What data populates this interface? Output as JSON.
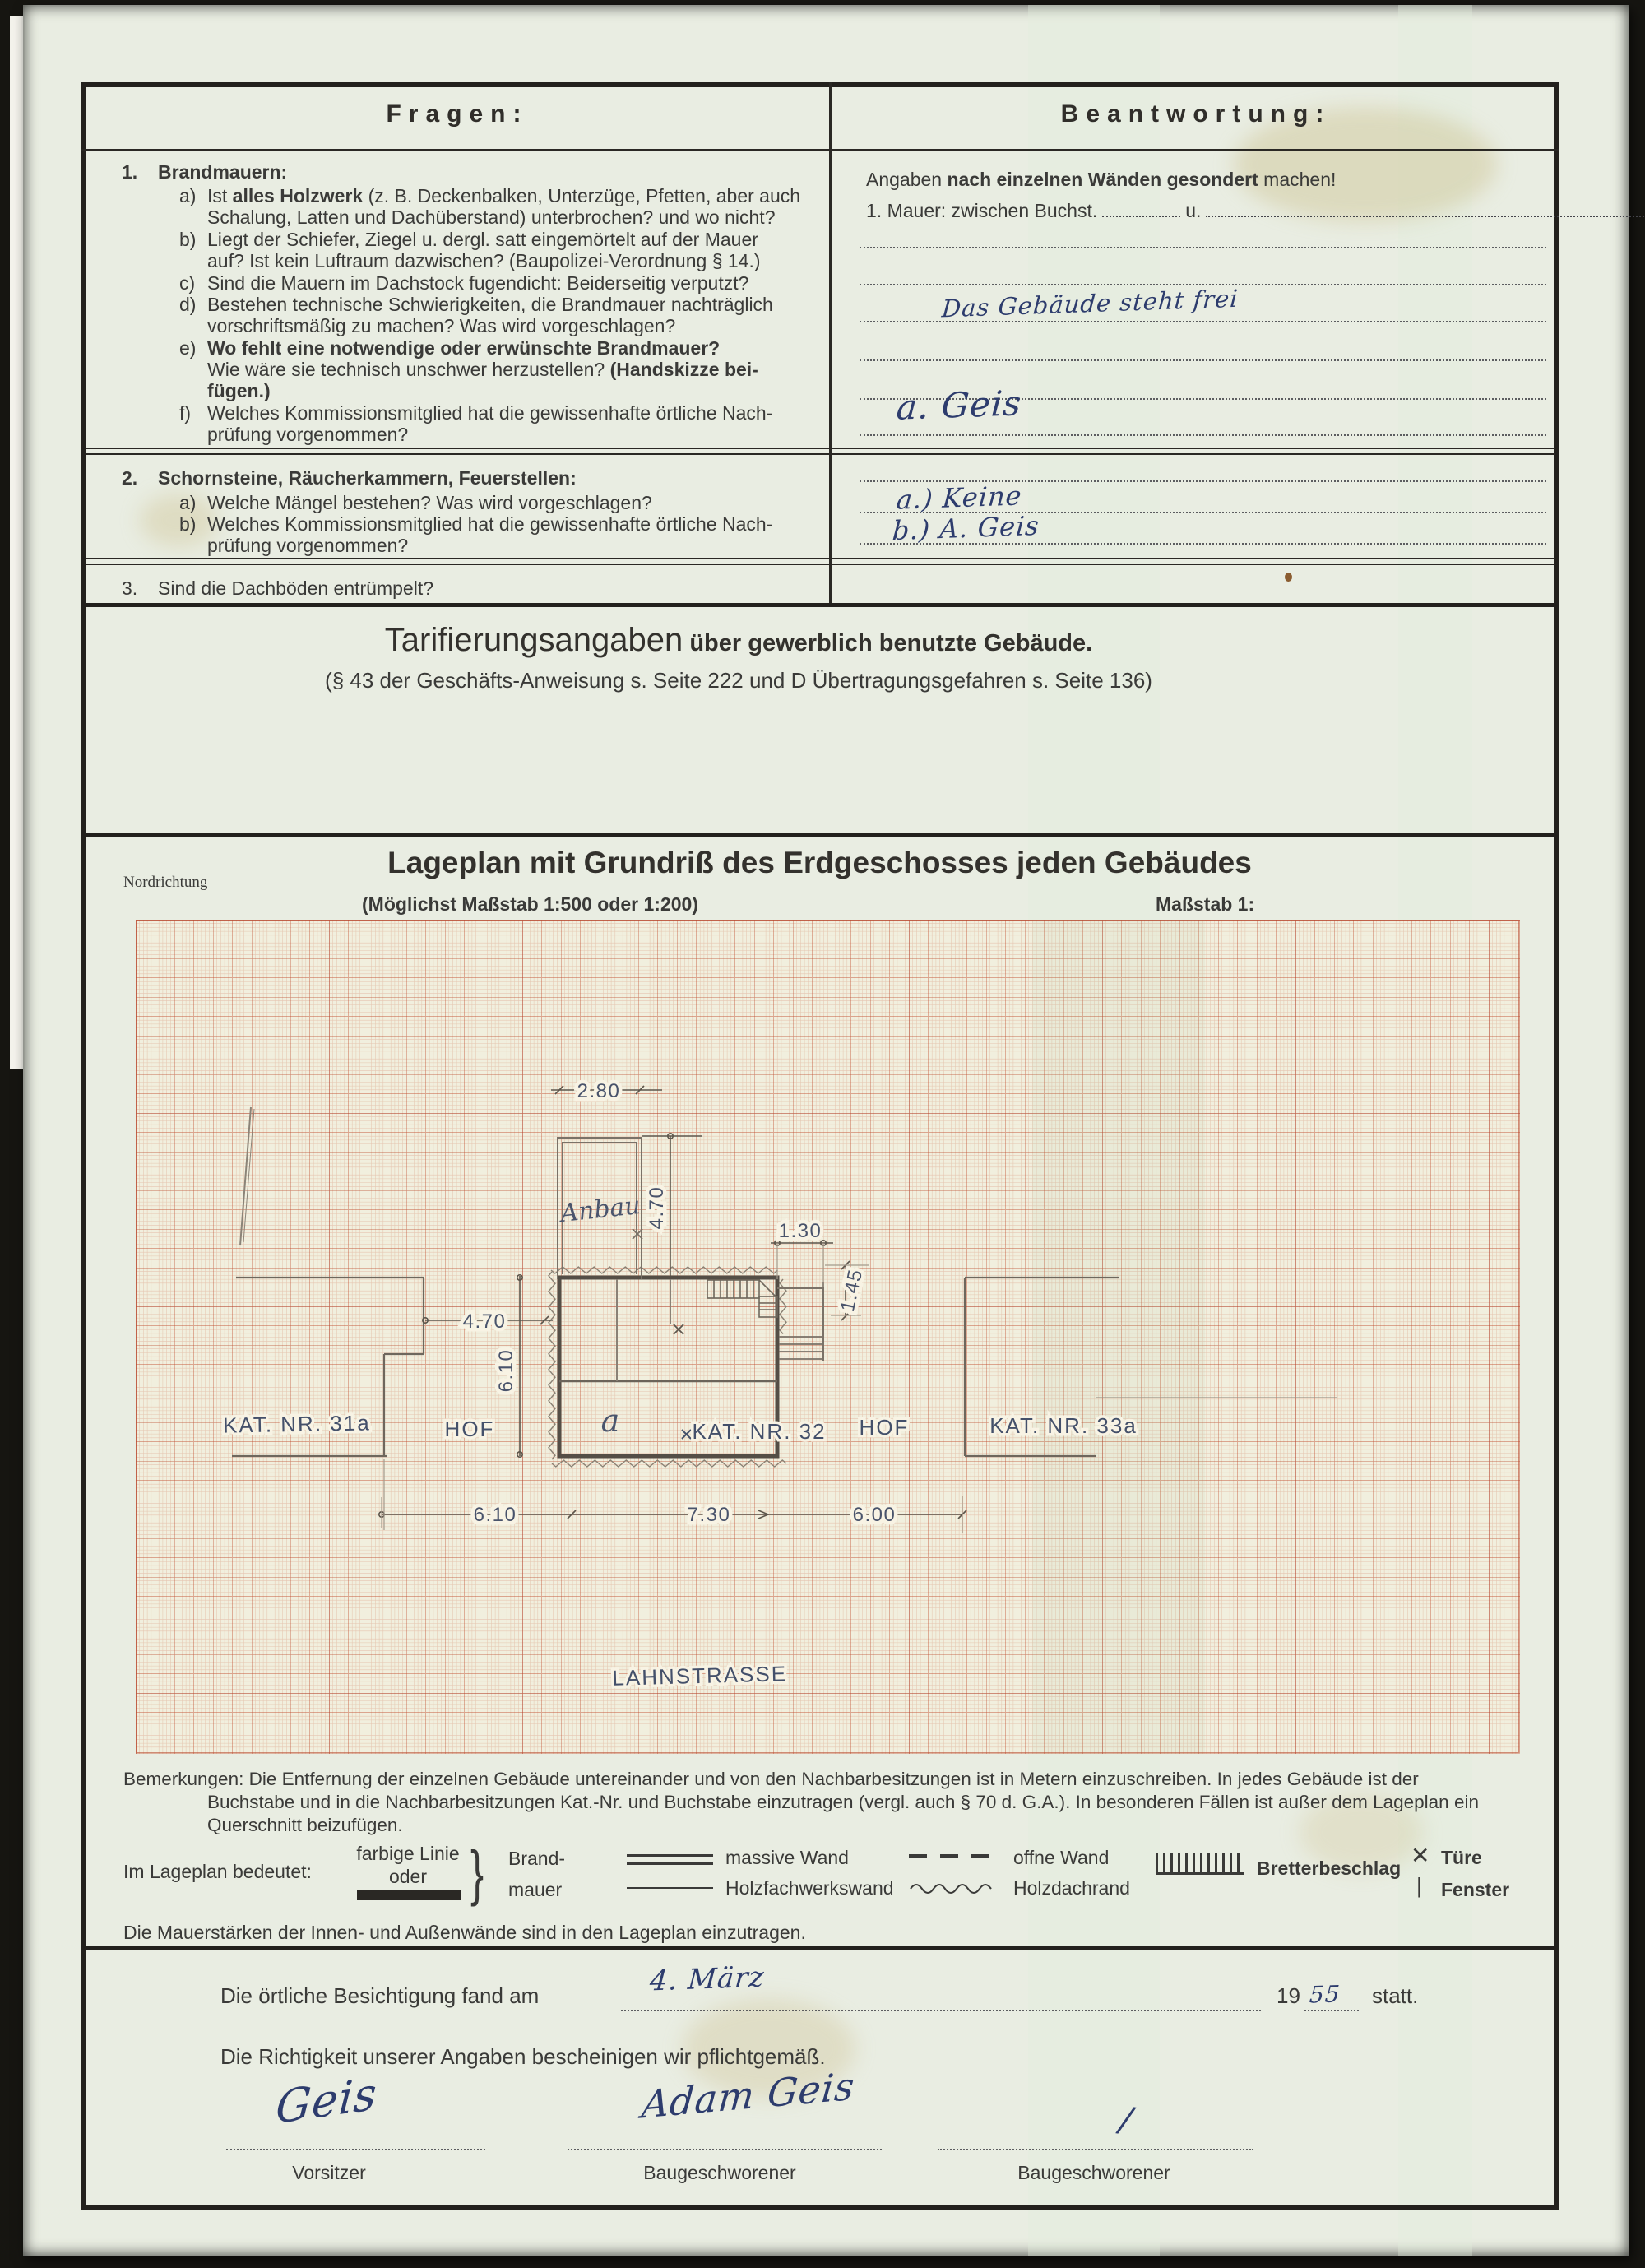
{
  "header": {
    "left": "Fragen:",
    "right": "Beantwortung:"
  },
  "q1": {
    "num": "1.",
    "title": "Brandmauern:",
    "items": [
      {
        "k": "a)",
        "lines": [
          [
            {
              "t": "Ist "
            },
            {
              "t": "alles Holzwerk",
              "b": true
            },
            {
              "t": " (z. B. Deckenbalken, Unterzüge, Pfetten, aber auch"
            }
          ],
          [
            {
              "t": "Schalung, Latten und Dachüberstand) unterbrochen? und wo nicht?"
            }
          ]
        ]
      },
      {
        "k": "b)",
        "lines": [
          [
            {
              "t": "Liegt der Schiefer, Ziegel  u. dergl.  satt eingemörtelt auf der Mauer"
            }
          ],
          [
            {
              "t": "auf? Ist kein Luftraum dazwischen? (Baupolizei-Verordnung § 14.)"
            }
          ]
        ]
      },
      {
        "k": "c)",
        "lines": [
          [
            {
              "t": "Sind die Mauern im Dachstock fugendicht: Beiderseitig verputzt?"
            }
          ]
        ]
      },
      {
        "k": "d)",
        "lines": [
          [
            {
              "t": "Bestehen technische Schwierigkeiten, die Brandmauer nachträglich"
            }
          ],
          [
            {
              "t": "vorschriftsmäßig zu machen? Was wird vorgeschlagen?"
            }
          ]
        ]
      },
      {
        "k": "e)",
        "lines": [
          [
            {
              "t": "Wo fehlt eine notwendige oder erwünschte Brandmauer?",
              "b": true
            }
          ],
          [
            {
              "t": "Wie wäre sie technisch unschwer herzustellen? "
            },
            {
              "t": "(Handskizze bei-",
              "b": true
            }
          ],
          [
            {
              "t": "fügen.)",
              "b": true
            }
          ]
        ]
      },
      {
        "k": "f)",
        "lines": [
          [
            {
              "t": "Welches Kommissionsmitglied hat die gewissenhafte örtliche Nach-"
            }
          ],
          [
            {
              "t": "prüfung vorgenommen?"
            }
          ]
        ]
      }
    ]
  },
  "q2": {
    "num": "2.",
    "title": "Schornsteine, Räucherkammern, Feuerstellen:",
    "a_k": "a)",
    "a_text": "Welche Mängel bestehen?  Was wird vorgeschlagen?",
    "b_k": "b)",
    "b_line1": "Welches Kommissionsmitglied hat die gewissenhafte örtliche Nach-",
    "b_line2": "prüfung vorgenommen?"
  },
  "q3": {
    "num": "3.",
    "text": "Sind die Dachböden entrümpelt?"
  },
  "answers": {
    "intro": [
      {
        "t": "Angaben "
      },
      {
        "t": "nach einzelnen Wänden gesondert",
        "b": true
      },
      {
        "t": " machen!"
      }
    ],
    "mauer_pre": "1. Mauer:  zwischen  Buchst.",
    "mauer_u": "u.",
    "hw1": "Das Gebäude steht frei",
    "hw2": "a. Geis",
    "q2a": "a.) Keine",
    "q2b": "b.) A. Geis"
  },
  "tarif": {
    "title_main": "Tarifierungsangaben",
    "title_rest": " über gewerblich benutzte Gebäude.",
    "subtitle": "(§ 43 der Geschäfts-Anweisung s. Seite 222 und D Übertragungsgefahren s. Seite 136)"
  },
  "lageplan": {
    "title": "Lageplan mit Grundriß des Erdgeschosses jeden Gebäudes",
    "north": "Nordrichtung",
    "scale_hint": "(Möglichst Maßstab 1:500 oder 1:200)",
    "massstab": "Maßstab 1:"
  },
  "plan": {
    "labels": {
      "kat31": "KAT. NR. 31a",
      "hof_left": "HOF",
      "a": "a",
      "kat32": "KAT. NR. 32",
      "hof_right": "HOF",
      "kat33": "KAT. NR. 33a",
      "anbau": "Anbau",
      "street": "LAHNSTRASSE"
    },
    "dims": {
      "d280": "2.80",
      "d470a": "4.70",
      "d130": "1.30",
      "d145": "1.45",
      "d610v": "6.10",
      "d470b": "4.70",
      "d610": "6.10",
      "d730": "7.30",
      "d600": "6.00"
    }
  },
  "remarks": {
    "l1": "Bemerkungen: Die Entfernung der einzelnen Gebäude untereinander und von den Nachbarbesitzungen ist in Metern einzuschreiben.  In jedes Gebäude ist der",
    "l2": "Buchstabe und in die Nachbarbesitzungen Kat.-Nr. und Buchstabe einzutragen (vergl. auch § 70 d. G.A.).  In besonderen Fällen ist außer dem Lageplan ein",
    "l3": "Querschnitt beizufügen.",
    "mauerstaerken": "Die Mauerstärken der Innen- und Außenwände sind in den Lageplan einzutragen."
  },
  "legend": {
    "intro": "Im Lageplan bedeutet:",
    "farbige": "farbige Linie",
    "oder": "oder",
    "brand1": "Brand-",
    "brand2": "mauer",
    "massive": "massive Wand",
    "holzfachwerk": "Holzfachwerkswand",
    "offne": "offne Wand",
    "holzdach": "Holzdachrand",
    "bretter": "Bretterbeschlag",
    "tuere": "Türe",
    "fenster": "Fenster"
  },
  "inspection": {
    "pre": "Die örtliche Besichtigung fand am",
    "date_hw": "4. März",
    "year": "19",
    "year_hw": "55",
    "statt": "statt.",
    "confirm": "Die Richtigkeit unserer Angaben bescheinigen wir pflichtgemäß."
  },
  "signatures": {
    "sig1": "Geis",
    "sig2": "Adam Geis",
    "sig3": "/",
    "label1": "Vorsitzer",
    "label2": "Baugeschworener",
    "label3": "Baugeschworener"
  },
  "colors": {
    "ink": "#2d3c6d",
    "print": "#3a3a38",
    "grid": "#c8735a",
    "paper": "#e9ede2"
  }
}
